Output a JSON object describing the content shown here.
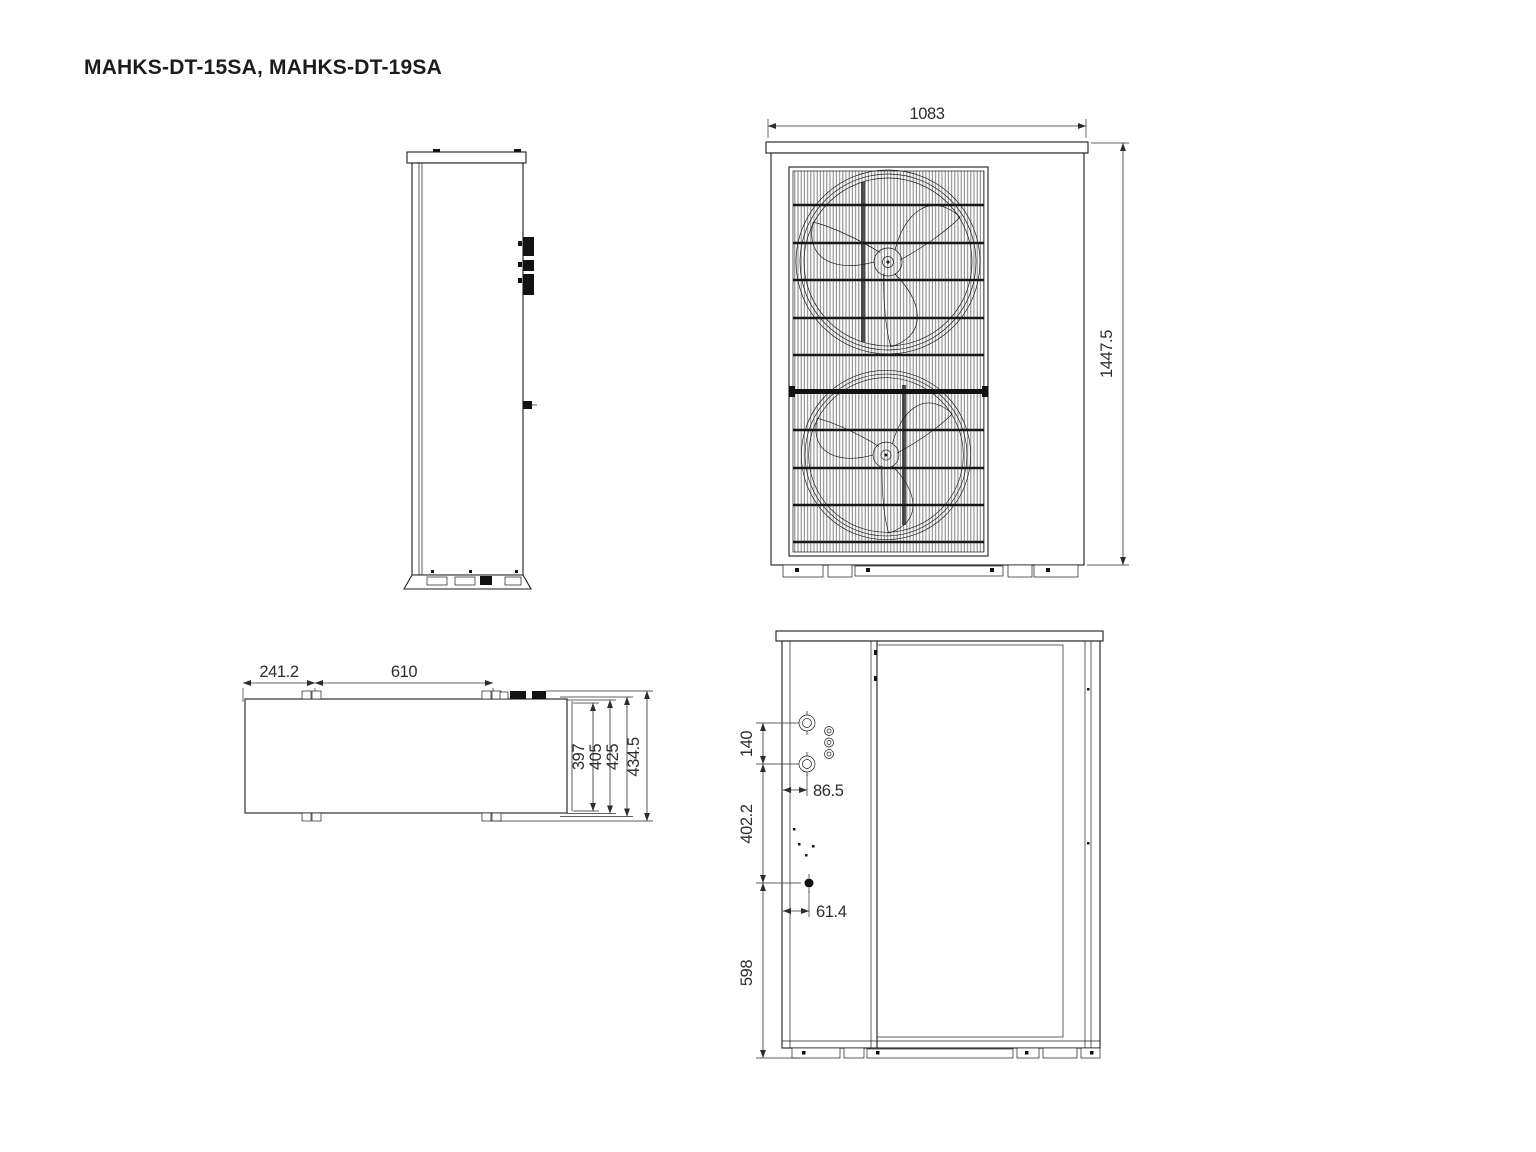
{
  "title": "MAHKS-DT-15SA, MAHKS-DT-19SA",
  "front_view": {
    "width": "1083",
    "height": "1447.5"
  },
  "top_view": {
    "foot_offset": "241.2",
    "foot_pitch": "610",
    "depths": [
      "397",
      "405",
      "425",
      "434.5"
    ]
  },
  "back_view": {
    "pipe_pitch": "140",
    "pipe_inset": "86.5",
    "mid_span": "402.2",
    "drain_inset": "61.4",
    "base_span": "598"
  },
  "colors": {
    "line": "#1c1c1c",
    "dim": "#2d2d2d",
    "background": "#ffffff"
  }
}
